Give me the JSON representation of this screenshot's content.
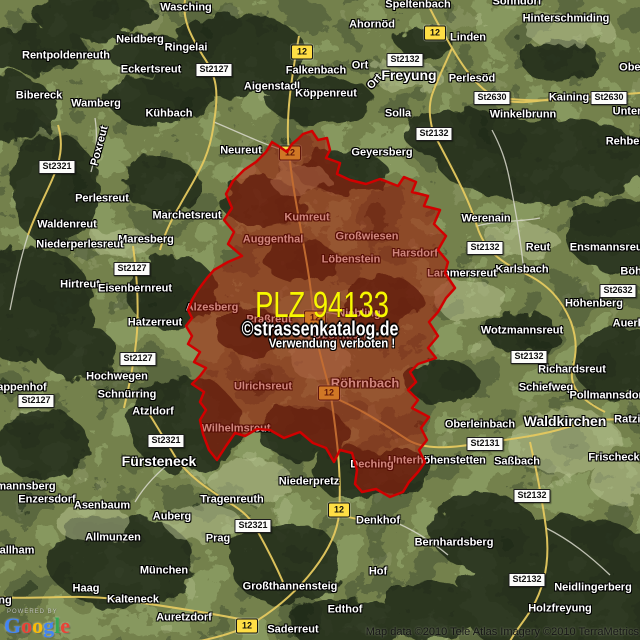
{
  "map": {
    "plz_overlay": {
      "title": "PLZ 94133",
      "watermark_line1": "©strassenkatalog.de",
      "watermark_line2": "Verwendung verboten !",
      "fill_color": "#a51908",
      "border_color": "#d10000",
      "polygon_points": "303,134 312,131 318,140 327,138 330,150 326,158 340,163 337,174 350,180 366,184 380,179 398,186 404,177 416,182 412,192 428,196 424,206 440,210 434,224 446,236 438,250 448,262 445,273 455,288 446,298 438,312 429,322 438,336 428,348 436,358 418,364 410,372 416,382 408,390 418,400 412,408 429,417 421,428 427,440 419,450 425,462 418,472 409,482 403,492 390,497 376,489 362,492 355,484 357,470 352,453 340,450 334,462 326,448 313,443 300,432 284,438 270,430 257,429 245,436 235,433 226,446 217,460 209,450 203,434 200,420 206,410 200,402 204,392 192,384 200,376 206,368 194,362 200,352 188,344 192,336 186,326 192,318 188,310 192,300 198,290 207,278 214,270 228,262 242,256 228,244 234,232 224,220 232,208 226,194 233,181 244,170 256,162 266,152 272,142 280,147 287,152 292,144 298,139"
    },
    "route_badges": [
      {
        "label": "12",
        "x": 302,
        "y": 52
      },
      {
        "label": "12",
        "x": 435,
        "y": 33
      },
      {
        "label": "12",
        "x": 290,
        "y": 153
      },
      {
        "label": "12",
        "x": 315,
        "y": 318
      },
      {
        "label": "12",
        "x": 329,
        "y": 393
      },
      {
        "label": "12",
        "x": 339,
        "y": 510
      },
      {
        "label": "12",
        "x": 247,
        "y": 626
      }
    ],
    "road_badges": [
      {
        "label": "St2127",
        "x": 214,
        "y": 70
      },
      {
        "label": "St2132",
        "x": 405,
        "y": 60
      },
      {
        "label": "St2630",
        "x": 492,
        "y": 98
      },
      {
        "label": "St2630",
        "x": 609,
        "y": 98
      },
      {
        "label": "St2132",
        "x": 434,
        "y": 134
      },
      {
        "label": "St2321",
        "x": 57,
        "y": 167
      },
      {
        "label": "St2132",
        "x": 485,
        "y": 248
      },
      {
        "label": "St2127",
        "x": 132,
        "y": 269
      },
      {
        "label": "St2632",
        "x": 618,
        "y": 291
      },
      {
        "label": "St2127",
        "x": 138,
        "y": 359
      },
      {
        "label": "St2132",
        "x": 529,
        "y": 357
      },
      {
        "label": "St2127",
        "x": 36,
        "y": 401
      },
      {
        "label": "St2321",
        "x": 166,
        "y": 441
      },
      {
        "label": "St2131",
        "x": 485,
        "y": 444
      },
      {
        "label": "St2132",
        "x": 532,
        "y": 496
      },
      {
        "label": "St2321",
        "x": 253,
        "y": 526
      },
      {
        "label": "St2132",
        "x": 527,
        "y": 580
      }
    ],
    "labels": [
      {
        "t": "Wasching",
        "x": 186,
        "y": 8
      },
      {
        "t": "Sonndorf",
        "x": 517,
        "y": 2
      },
      {
        "t": "Speltenbach",
        "x": 418,
        "y": 5
      },
      {
        "t": "Hinterschmiding",
        "x": 566,
        "y": 19
      },
      {
        "t": "Ahornöd",
        "x": 372,
        "y": 25
      },
      {
        "t": "Neidberg",
        "x": 140,
        "y": 40
      },
      {
        "t": "Linden",
        "x": 468,
        "y": 38
      },
      {
        "t": "Ringelai",
        "x": 186,
        "y": 48
      },
      {
        "t": "Rentpoldenreuth",
        "x": 66,
        "y": 56
      },
      {
        "t": "Ort",
        "x": 360,
        "y": 66
      },
      {
        "t": "Ort",
        "x": 375,
        "y": 82,
        "r": -48
      },
      {
        "t": "Eckertsreut",
        "x": 151,
        "y": 70
      },
      {
        "t": "Falkenbach",
        "x": 316,
        "y": 71
      },
      {
        "t": "Freyung",
        "x": 409,
        "y": 75,
        "s": "lg"
      },
      {
        "t": "Perlesöd",
        "x": 472,
        "y": 79
      },
      {
        "t": "Ober",
        "x": 632,
        "y": 68
      },
      {
        "t": "Aigenstadl",
        "x": 272,
        "y": 87
      },
      {
        "t": "Köppenreut",
        "x": 326,
        "y": 94
      },
      {
        "t": "Bibereck",
        "x": 39,
        "y": 96
      },
      {
        "t": "Wamberg",
        "x": 96,
        "y": 104
      },
      {
        "t": "Kaining",
        "x": 569,
        "y": 98
      },
      {
        "t": "Solla",
        "x": 398,
        "y": 114
      },
      {
        "t": "Kühbach",
        "x": 169,
        "y": 114
      },
      {
        "t": "Winkelbrunn",
        "x": 523,
        "y": 115
      },
      {
        "t": "Unter",
        "x": 627,
        "y": 112
      },
      {
        "t": "Rehberg",
        "x": 628,
        "y": 142
      },
      {
        "t": "Poxreut",
        "x": 100,
        "y": 146,
        "r": -75
      },
      {
        "t": "Neureut",
        "x": 241,
        "y": 151
      },
      {
        "t": "Geyersberg",
        "x": 382,
        "y": 153
      },
      {
        "t": "Perlesreut",
        "x": 102,
        "y": 199
      },
      {
        "t": "Marchetsreut",
        "x": 187,
        "y": 216
      },
      {
        "t": "Kumreut",
        "x": 307,
        "y": 218
      },
      {
        "t": "Werenain",
        "x": 486,
        "y": 219
      },
      {
        "t": "Waldenreut",
        "x": 67,
        "y": 225
      },
      {
        "t": "Großwiesen",
        "x": 367,
        "y": 237
      },
      {
        "t": "Auggenthal",
        "x": 273,
        "y": 240
      },
      {
        "t": "Maresberg",
        "x": 146,
        "y": 240
      },
      {
        "t": "Niederperlesreut",
        "x": 80,
        "y": 245
      },
      {
        "t": "Ensmannsreut",
        "x": 608,
        "y": 248
      },
      {
        "t": "Reut",
        "x": 538,
        "y": 248
      },
      {
        "t": "Harsdorf",
        "x": 415,
        "y": 254
      },
      {
        "t": "Löbenstein",
        "x": 351,
        "y": 260
      },
      {
        "t": "Karlsbach",
        "x": 522,
        "y": 270
      },
      {
        "t": "Böhm",
        "x": 636,
        "y": 272
      },
      {
        "t": "Lammersreut",
        "x": 462,
        "y": 274
      },
      {
        "t": "Hirtreut",
        "x": 80,
        "y": 285
      },
      {
        "t": "Eisenbernreut",
        "x": 135,
        "y": 289
      },
      {
        "t": "Höhenberg",
        "x": 594,
        "y": 304
      },
      {
        "t": "Alzesberg",
        "x": 212,
        "y": 308
      },
      {
        "t": "Niebling",
        "x": 359,
        "y": 314
      },
      {
        "t": "Praßreut",
        "x": 269,
        "y": 320
      },
      {
        "t": "Hatzerreut",
        "x": 155,
        "y": 323
      },
      {
        "t": "Auerbach",
        "x": 638,
        "y": 324
      },
      {
        "t": "Wotzmannsreut",
        "x": 522,
        "y": 331
      },
      {
        "t": "Oberndorf",
        "x": 340,
        "y": 336
      },
      {
        "t": "Richardsreut",
        "x": 572,
        "y": 370
      },
      {
        "t": "Hochwegen",
        "x": 117,
        "y": 377
      },
      {
        "t": "Ulrichsreut",
        "x": 263,
        "y": 387
      },
      {
        "t": "Röhrnbach",
        "x": 365,
        "y": 383,
        "s": "md"
      },
      {
        "t": "Rappenhof",
        "x": 18,
        "y": 388
      },
      {
        "t": "Schiefweg",
        "x": 546,
        "y": 388
      },
      {
        "t": "Schnürring",
        "x": 127,
        "y": 395
      },
      {
        "t": "Pollmannsdorf",
        "x": 608,
        "y": 396
      },
      {
        "t": "Atzldorf",
        "x": 153,
        "y": 412
      },
      {
        "t": "Oberleinbach",
        "x": 480,
        "y": 425
      },
      {
        "t": "Waldkirchen",
        "x": 565,
        "y": 421,
        "s": "lg"
      },
      {
        "t": "Ratzing",
        "x": 634,
        "y": 420
      },
      {
        "t": "Wilhelmsreut",
        "x": 236,
        "y": 429
      },
      {
        "t": "Fürsteneck",
        "x": 159,
        "y": 461,
        "s": "lg"
      },
      {
        "t": "Unterhöhenstetten",
        "x": 437,
        "y": 461
      },
      {
        "t": "Saßbach",
        "x": 517,
        "y": 462
      },
      {
        "t": "Frischeck",
        "x": 614,
        "y": 458
      },
      {
        "t": "Deching",
        "x": 372,
        "y": 465
      },
      {
        "t": "Niederpretz",
        "x": 309,
        "y": 482
      },
      {
        "t": "mannsberg",
        "x": 26,
        "y": 487
      },
      {
        "t": "Enzersdorf",
        "x": 47,
        "y": 500
      },
      {
        "t": "Tragenreuth",
        "x": 232,
        "y": 500
      },
      {
        "t": "Asenbaum",
        "x": 102,
        "y": 506
      },
      {
        "t": "Auberg",
        "x": 172,
        "y": 517
      },
      {
        "t": "Denkhof",
        "x": 378,
        "y": 521
      },
      {
        "t": "Prag",
        "x": 218,
        "y": 539
      },
      {
        "t": "Allmunzen",
        "x": 113,
        "y": 538
      },
      {
        "t": "Bernhardsberg",
        "x": 454,
        "y": 543
      },
      {
        "t": "allham",
        "x": 17,
        "y": 551
      },
      {
        "t": "München",
        "x": 164,
        "y": 571
      },
      {
        "t": "Hof",
        "x": 378,
        "y": 572
      },
      {
        "t": "Haag",
        "x": 86,
        "y": 589
      },
      {
        "t": "Neidlingerberg",
        "x": 593,
        "y": 588
      },
      {
        "t": "Großthannensteig",
        "x": 290,
        "y": 587
      },
      {
        "t": "Kalteneck",
        "x": 133,
        "y": 600
      },
      {
        "t": "ng",
        "x": 5,
        "y": 601
      },
      {
        "t": "Holzfreyung",
        "x": 560,
        "y": 609
      },
      {
        "t": "Edthof",
        "x": 345,
        "y": 610
      },
      {
        "t": "Auretzdorf",
        "x": 184,
        "y": 618
      },
      {
        "t": "Saderreut",
        "x": 293,
        "y": 630
      }
    ],
    "chrome": {
      "powered_by": "POWERED BY",
      "logo_letters": [
        {
          "ch": "G",
          "color": "#4285f4"
        },
        {
          "ch": "o",
          "color": "#ea4335"
        },
        {
          "ch": "o",
          "color": "#fbbc05"
        },
        {
          "ch": "g",
          "color": "#4285f4"
        },
        {
          "ch": "l",
          "color": "#34a853"
        },
        {
          "ch": "e",
          "color": "#ea4335"
        }
      ],
      "attribution": "Map data ©2010 Tele Atlas  Imagery ©2010 TerraMetrics"
    }
  }
}
